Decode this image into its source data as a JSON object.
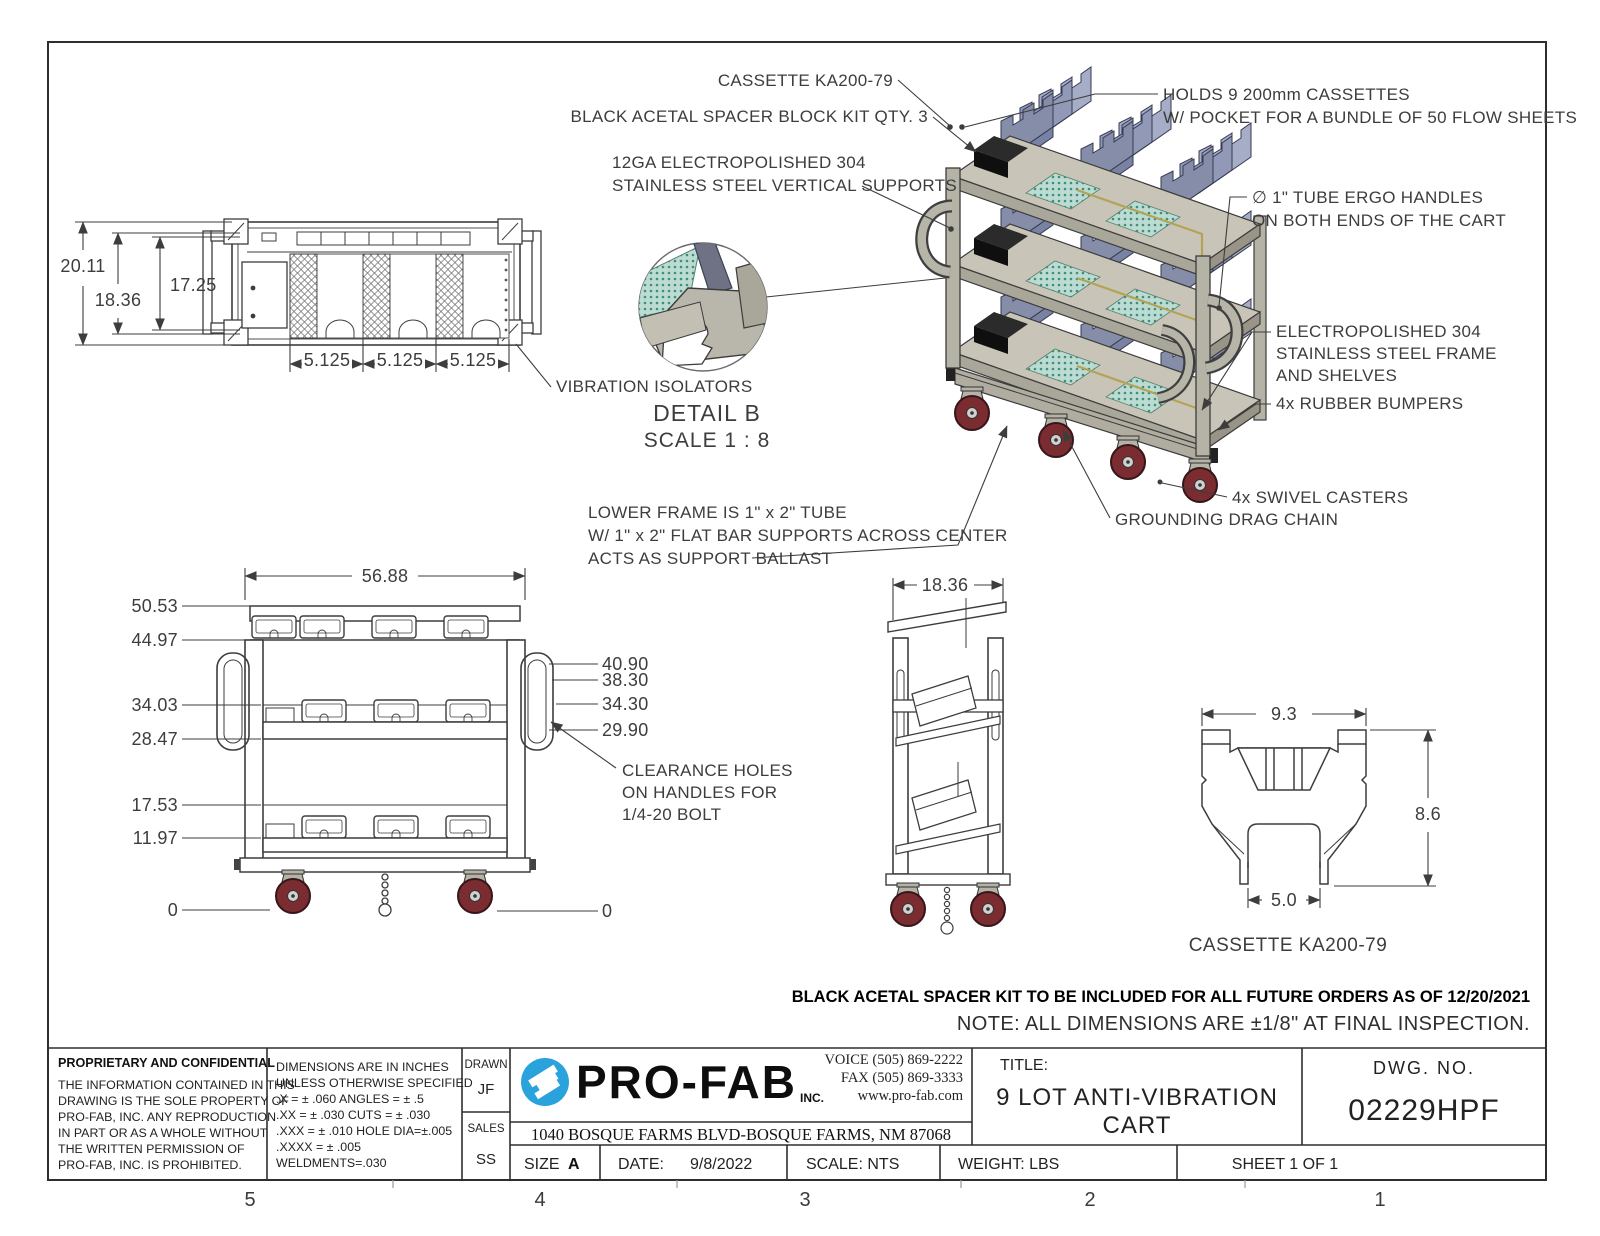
{
  "views": {
    "top_view": {
      "dims_left": [
        "20.11",
        "18.36",
        "17.25"
      ],
      "dims_pitch": [
        "5.125",
        "5.125",
        "5.125"
      ],
      "isolator_label": "VIBRATION ISOLATORS"
    },
    "detail_b": {
      "title": "DETAIL B",
      "scale": "SCALE 1 : 8"
    },
    "iso": {
      "cassette": "CASSETTE KA200-79",
      "spacer": "BLACK ACETAL SPACER BLOCK KIT QTY. 3",
      "supports": [
        "12GA ELECTROPOLISHED 304",
        "STAINLESS STEEL VERTICAL SUPPORTS"
      ],
      "holds": [
        "HOLDS 9 200mm CASSETTES",
        "W/ POCKET FOR A BUNDLE OF 50 FLOW SHEETS"
      ],
      "handles": [
        "∅ 1\" TUBE ERGO HANDLES",
        "ON BOTH ENDS OF THE CART"
      ],
      "frame": [
        "ELECTROPOLISHED 304",
        "STAINLESS STEEL FRAME",
        "AND SHELVES"
      ],
      "bumpers": "4x RUBBER BUMPERS",
      "casters": "4x SWIVEL CASTERS",
      "chain": "GROUNDING DRAG CHAIN",
      "lower_frame": [
        "LOWER FRAME IS 1\" x 2\" TUBE",
        "W/ 1\" x 2\" FLAT BAR SUPPORTS ACROSS CENTER",
        "ACTS AS SUPPORT BALLAST"
      ]
    },
    "front_view": {
      "dim_width": "56.88",
      "dims_left": [
        "50.53",
        "44.97",
        "34.03",
        "28.47",
        "17.53",
        "11.97",
        "0"
      ],
      "dims_right": [
        "40.90",
        "38.30",
        "34.30",
        "29.90",
        "0"
      ],
      "clearance": [
        "CLEARANCE HOLES",
        "ON HANDLES FOR",
        "1/4-20 BOLT"
      ]
    },
    "side_view": {
      "dim_depth": "18.36"
    },
    "cassette_detail": {
      "dim_width": "9.3",
      "dim_height": "8.6",
      "dim_slot": "5.0",
      "caption": "CASSETTE KA200-79"
    }
  },
  "notes": {
    "spacer_note": "BLACK ACETAL SPACER KIT TO BE INCLUDED FOR ALL FUTURE ORDERS AS OF 12/20/2021",
    "dim_note": "NOTE: ALL DIMENSIONS ARE ±1/8\" AT FINAL INSPECTION."
  },
  "title_block": {
    "proprietary": {
      "heading": "PROPRIETARY AND CONFIDENTIAL",
      "lines": [
        "THE INFORMATION CONTAINED IN THIS",
        "DRAWING IS THE SOLE PROPERTY OF",
        "PRO-FAB, INC.  ANY REPRODUCTION",
        "IN PART OR AS A WHOLE WITHOUT",
        "THE WRITTEN PERMISSION OF",
        "PRO-FAB, INC. IS PROHIBITED."
      ]
    },
    "tolerances": {
      "lines": [
        "DIMENSIONS ARE IN INCHES",
        "UNLESS OTHERWISE SPECIFIED",
        ".X = ± .060      ANGLES = ± .5",
        ".XX = ± .030     CUTS = ± .030",
        ".XXX = ± .010   HOLE DIA=±.005",
        ".XXXX = ± .005",
        "WELDMENTS=.030"
      ]
    },
    "signoff": {
      "drawn_label": "DRAWN",
      "drawn": "JF",
      "sales_label": "SALES",
      "sales": "SS"
    },
    "company": {
      "name": "PRO-FAB",
      "suffix": "INC.",
      "voice": "VOICE (505) 869-2222",
      "fax": "FAX (505) 869-3333",
      "web": "www.pro-fab.com",
      "address": "1040 BOSQUE FARMS BLVD-BOSQUE FARMS, NM 87068"
    },
    "title_label": "TITLE:",
    "title_lines": [
      "9 LOT ANTI-VIBRATION",
      "CART"
    ],
    "dwg_label": "DWG.  NO.",
    "dwg_no": "02229HPF",
    "size_label": "SIZE",
    "size": "A",
    "date_label": "DATE:",
    "date": "9/8/2022",
    "scale": "SCALE: NTS",
    "weight": "WEIGHT:  LBS",
    "sheet": "SHEET 1 OF 1"
  },
  "zones": [
    "5",
    "4",
    "3",
    "2",
    "1"
  ],
  "colors": {
    "line": "#3d3d3d",
    "frame_gray": "#b5b2a6",
    "shelf_tan": "#c8c5b8",
    "cassette_blue": "#9299b7",
    "teal": "#bcdbd2",
    "caster_red": "#7b2c30",
    "logo_blue": "#2aa3dd"
  }
}
